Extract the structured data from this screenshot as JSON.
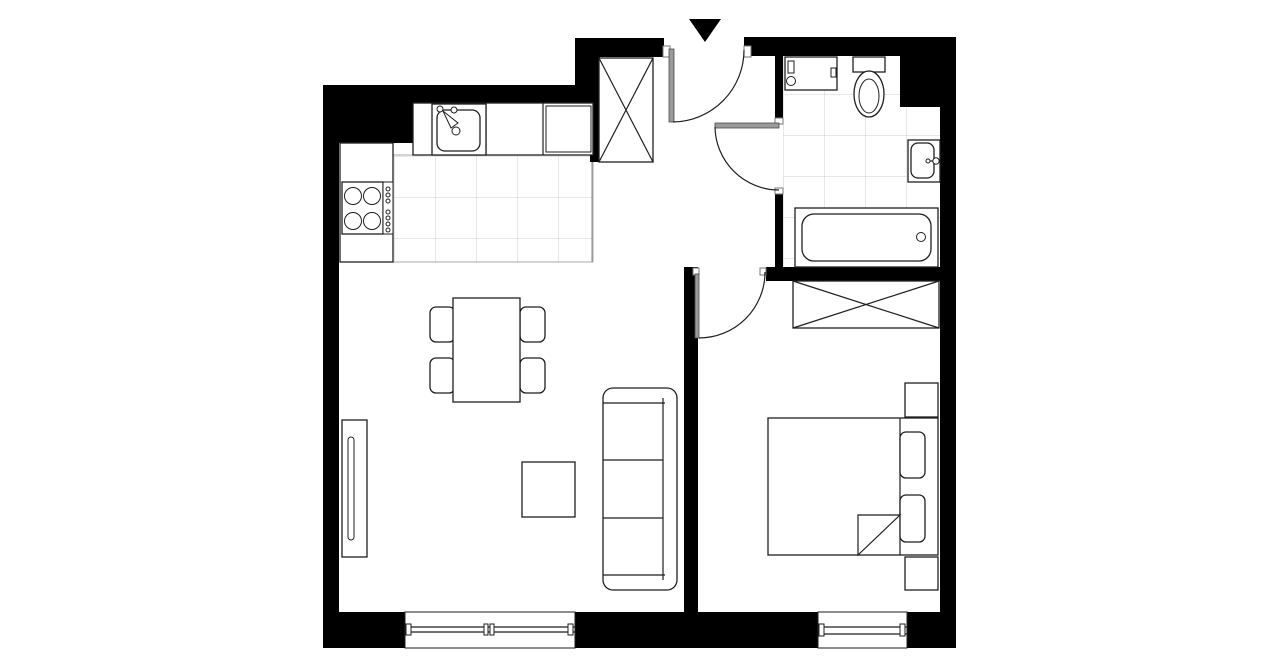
{
  "meta": {
    "drawing_type": "apartment floor plan, top view, black and white",
    "background_color": "#ffffff",
    "wall_color": "#000000",
    "outline_color": "#1f1f1f",
    "tile_grid_color": "#cfcfcf",
    "entrance_marker": "solid black triangle pointing down above entrance door"
  },
  "rooms": {
    "hall": {
      "label": "Entrance hall",
      "items": [
        "entrance door swinging inward",
        "built-in closet marked with X",
        "door to bathroom",
        "door to bedroom"
      ]
    },
    "kitchen_living": {
      "label": "Open-plan kitchen and living room",
      "items": [
        "counter with sink",
        "appliance unit",
        "cooktop with 4 burners and control dots",
        "tiled kitchen floor",
        "dining table with 4 chairs",
        "wall radiator",
        "square coffee table",
        "three-seat sofa",
        "window in bottom wall"
      ]
    },
    "bathroom": {
      "label": "Bathroom",
      "items": [
        "washing machine",
        "toilet with tank",
        "washbasin",
        "bathtub",
        "tiled floor"
      ]
    },
    "bedroom": {
      "label": "Bedroom",
      "items": [
        "wardrobe marked with X",
        "double bed",
        "two pillows",
        "two nightstands",
        "folded blanket corner",
        "window in bottom wall"
      ]
    }
  }
}
